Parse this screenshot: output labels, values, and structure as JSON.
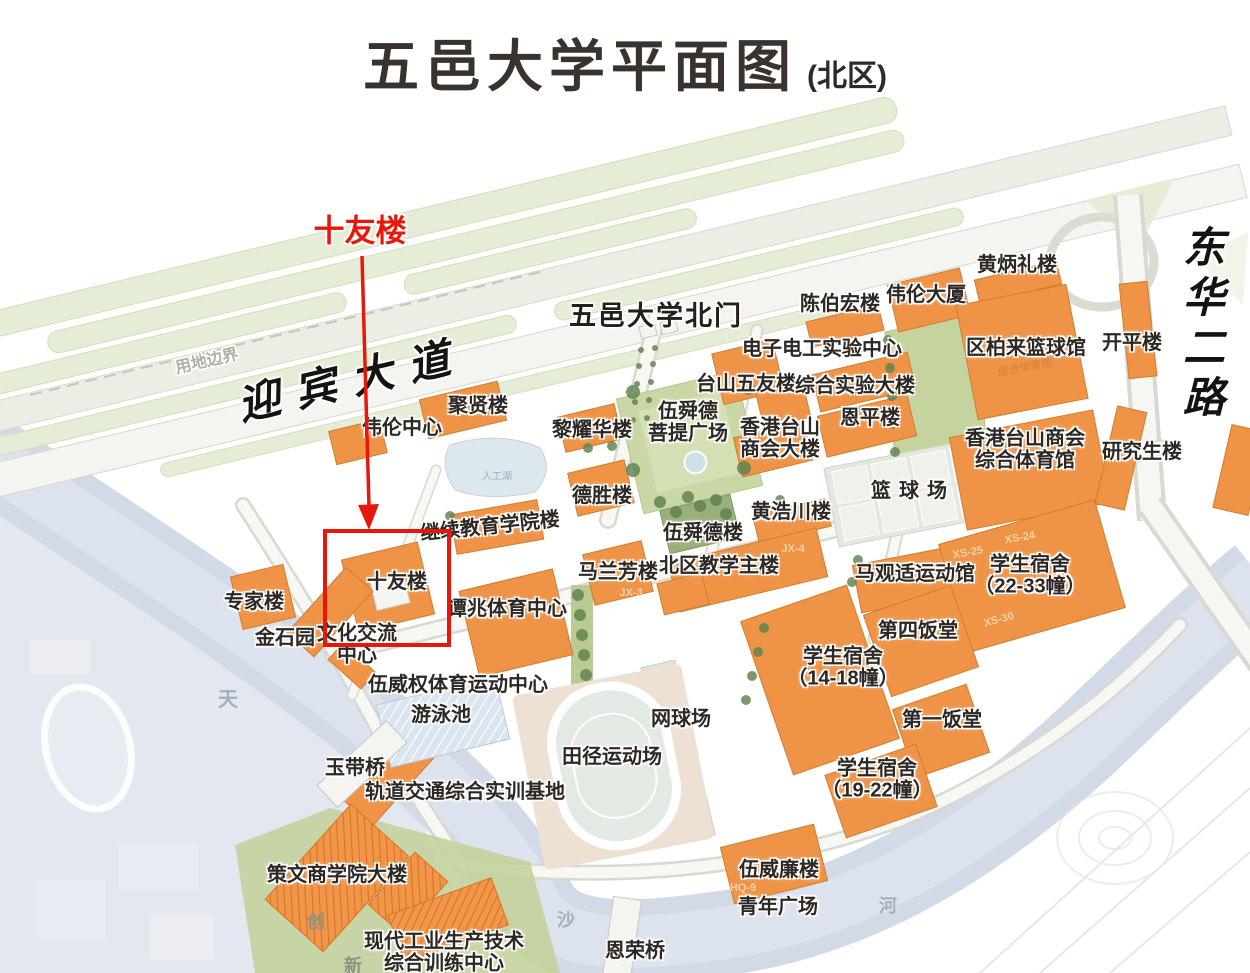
{
  "header": {
    "title": "五邑大学平面图",
    "subtitle": "(北区)"
  },
  "annotation": {
    "label": "十友楼",
    "color": "#e8170b",
    "rect": {
      "x": 323,
      "y": 529,
      "w": 120,
      "h": 110
    },
    "arrow": {
      "x1": 362,
      "y1": 256,
      "x2": 369,
      "y2": 506,
      "head": "369,530 358,505 379,504"
    }
  },
  "colors": {
    "building_orange": "#ef9347",
    "building_outline": "#d27c2e",
    "lawn_green": "#c8d6a4",
    "water_blue": "#d6dfeb",
    "road_grey": "#d8d9d0",
    "annotation_red": "#e8170b",
    "label_dark": "#2d2823"
  },
  "map": {
    "labels": [
      {
        "id": "annotation-label",
        "t": "十友楼",
        "x": 360,
        "y": 232,
        "s": 31,
        "cls": "red"
      },
      {
        "id": "road-yingbin-avenue",
        "t": "迎宾大道",
        "x": 352,
        "y": 382,
        "s": 42,
        "r": -13,
        "ls": 16,
        "cls": "road"
      },
      {
        "id": "road-donghua-2nd-road",
        "t": "东华二路",
        "x": 1199,
        "y": 325,
        "s": 42,
        "ls": 8,
        "cls": "road roadv"
      },
      {
        "id": "boundary-label",
        "t": "用地边界",
        "x": 207,
        "y": 362,
        "s": 16,
        "r": -13,
        "cls": "boundary"
      },
      {
        "id": "gate-north",
        "t": "五邑大学北门",
        "x": 656,
        "y": 316,
        "s": 27,
        "ls": 2,
        "cls": "gate"
      },
      {
        "t": "黄炳礼楼",
        "x": 1017,
        "y": 265,
        "s": 20
      },
      {
        "t": "陈伯宏楼",
        "x": 840,
        "y": 304,
        "s": 20
      },
      {
        "t": "伟伦大厦",
        "x": 926,
        "y": 295,
        "s": 20
      },
      {
        "t": "开平楼",
        "x": 1132,
        "y": 343,
        "s": 20
      },
      {
        "t": "区柏来篮球馆",
        "x": 1026,
        "y": 348,
        "s": 20
      },
      {
        "t": "电子电工实验中心",
        "x": 822,
        "y": 349,
        "s": 20
      },
      {
        "t": "台山五友楼",
        "x": 746,
        "y": 384,
        "s": 20
      },
      {
        "t": "综合实验大楼",
        "x": 855,
        "y": 386,
        "s": 20
      },
      {
        "t": "恩平楼",
        "x": 870,
        "y": 418,
        "s": 20
      },
      {
        "t": "香港台山\n商会大楼",
        "x": 780,
        "y": 439,
        "s": 20
      },
      {
        "t": "伍舜德\n菩提广场",
        "x": 688,
        "y": 423,
        "s": 20
      },
      {
        "t": "聚贤楼",
        "x": 478,
        "y": 406,
        "s": 20
      },
      {
        "t": "伟伦中心",
        "x": 402,
        "y": 428,
        "s": 20
      },
      {
        "t": "黎耀华楼",
        "x": 592,
        "y": 430,
        "s": 20
      },
      {
        "t": "研究生楼",
        "x": 1142,
        "y": 452,
        "s": 20
      },
      {
        "t": "香港台山商会\n综合体育馆",
        "x": 1025,
        "y": 450,
        "s": 20
      },
      {
        "t": "篮球场",
        "x": 913,
        "y": 491,
        "s": 20,
        "ls": 8
      },
      {
        "t": "德胜楼",
        "x": 602,
        "y": 496,
        "s": 20
      },
      {
        "t": "黄浩川楼",
        "x": 791,
        "y": 512,
        "s": 20
      },
      {
        "t": "伍舜德楼",
        "x": 703,
        "y": 533,
        "s": 20
      },
      {
        "t": "北区教学主楼",
        "x": 719,
        "y": 566,
        "s": 20
      },
      {
        "t": "马兰芳楼",
        "x": 618,
        "y": 572,
        "s": 20
      },
      {
        "t": "马观适运动馆",
        "x": 915,
        "y": 574,
        "s": 20
      },
      {
        "t": "学生宿舍\n（22-33幢）",
        "x": 1030,
        "y": 576,
        "s": 20
      },
      {
        "t": "继续教育学院楼",
        "x": 490,
        "y": 527,
        "s": 20,
        "r": -6
      },
      {
        "t": "十友楼",
        "x": 397,
        "y": 582,
        "s": 20
      },
      {
        "t": "专家楼",
        "x": 254,
        "y": 602,
        "s": 20
      },
      {
        "t": "谭兆体育中心",
        "x": 507,
        "y": 609,
        "s": 20
      },
      {
        "t": "金石园",
        "x": 285,
        "y": 638,
        "s": 20
      },
      {
        "t": "文化交流\n中心",
        "x": 357,
        "y": 645,
        "s": 20
      },
      {
        "t": "第四饭堂",
        "x": 918,
        "y": 631,
        "s": 20
      },
      {
        "t": "学生宿舍\n（14-18幢）",
        "x": 843,
        "y": 668,
        "s": 20
      },
      {
        "t": "第一饭堂",
        "x": 942,
        "y": 720,
        "s": 20
      },
      {
        "t": "学生宿舍\n（19-22幢）",
        "x": 877,
        "y": 780,
        "s": 20
      },
      {
        "t": "伍威权体育运动中心",
        "x": 458,
        "y": 685,
        "s": 20
      },
      {
        "t": "游泳池",
        "x": 441,
        "y": 715,
        "s": 20
      },
      {
        "t": "网球场",
        "x": 681,
        "y": 719,
        "s": 20
      },
      {
        "t": "田径运动场",
        "x": 612,
        "y": 757,
        "s": 20
      },
      {
        "t": "玉带桥",
        "x": 355,
        "y": 768,
        "s": 20
      },
      {
        "t": "轨道交通综合实训基地",
        "x": 465,
        "y": 792,
        "s": 20
      },
      {
        "t": "伍威廉楼",
        "x": 779,
        "y": 870,
        "s": 20
      },
      {
        "t": "青年广场",
        "x": 778,
        "y": 907,
        "s": 20
      },
      {
        "t": "策文商学院大楼",
        "x": 337,
        "y": 875,
        "s": 20
      },
      {
        "t": "现代工业生产技术\n综合训练中心",
        "x": 444,
        "y": 953,
        "s": 20
      },
      {
        "t": "恩荣桥",
        "x": 635,
        "y": 951,
        "s": 20
      },
      {
        "t": "天",
        "x": 228,
        "y": 700,
        "s": 20,
        "cls": "faint"
      },
      {
        "t": "沙",
        "x": 566,
        "y": 920,
        "s": 18,
        "cls": "faint"
      },
      {
        "t": "河",
        "x": 888,
        "y": 906,
        "s": 18,
        "cls": "faint"
      },
      {
        "t": "创",
        "x": 316,
        "y": 922,
        "s": 18,
        "cls": "grn"
      },
      {
        "t": "新",
        "x": 353,
        "y": 966,
        "s": 18,
        "cls": "grn"
      },
      {
        "t": "人工湖",
        "x": 497,
        "y": 477,
        "s": 10,
        "cls": "pond"
      },
      {
        "t": "综合体育馆",
        "x": 1025,
        "y": 368,
        "s": 11,
        "r": -11,
        "cls": "onbld"
      },
      {
        "t": "XS-24",
        "x": 1020,
        "y": 538,
        "s": 11,
        "r": -10,
        "cls": "code"
      },
      {
        "t": "XS-25",
        "x": 968,
        "y": 553,
        "s": 11,
        "r": -10,
        "cls": "code"
      },
      {
        "t": "XS-30",
        "x": 999,
        "y": 620,
        "s": 11,
        "r": -15,
        "cls": "code"
      },
      {
        "t": "JX-3",
        "x": 631,
        "y": 593,
        "s": 11,
        "cls": "code"
      },
      {
        "t": "JX-4",
        "x": 793,
        "y": 549,
        "s": 11,
        "cls": "code"
      },
      {
        "t": "HQ-9",
        "x": 743,
        "y": 888,
        "s": 11,
        "cls": "code"
      }
    ]
  }
}
